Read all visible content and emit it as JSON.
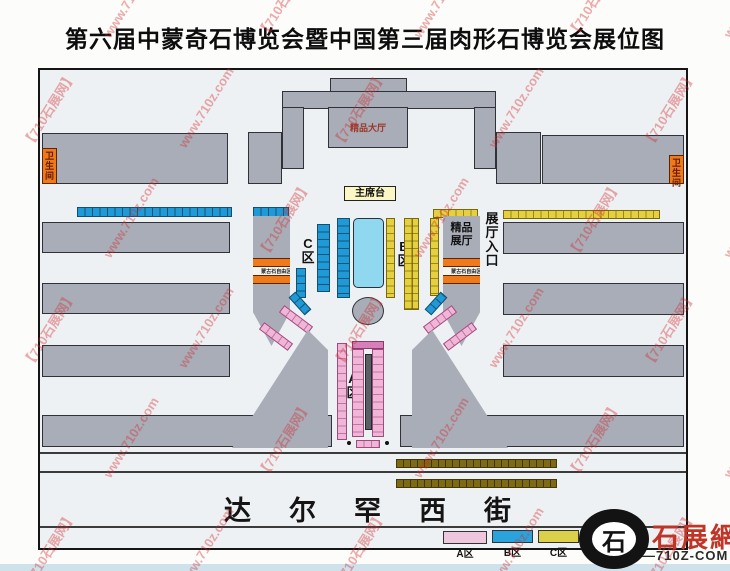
{
  "title": "第六届中蒙奇石博览会暨中国第三届肉形石博览会展位图",
  "watermark": {
    "texts": [
      "【710石展网】",
      "www.710z.com"
    ],
    "color": "#d42a2a",
    "opacity": 0.38,
    "angle_deg": -58
  },
  "map": {
    "buildings": {
      "boutique_hall": "精品大厅",
      "boutique_pavilion": "精品展厅",
      "restroom": "卫生间",
      "stage": "主席台",
      "hall_entrance": "展厅入口",
      "mongolian_stone_area": "蒙古石自由区"
    },
    "zones": {
      "a": "A区",
      "b": "B区",
      "c": "C区"
    },
    "street": "达尔罕西街",
    "colors": {
      "building_gray": "#a8adb8",
      "zone_a_pink": "#f0b6d7",
      "zone_b_blue": "#1f9ad6",
      "zone_c_yellow": "#e4d040",
      "pool_cyan": "#8fd8ef",
      "orange_band": "#ee7a1a",
      "olive_strip": "#7d6a12"
    }
  },
  "legend": {
    "items": [
      {
        "label": "A区",
        "color": "#eec6de"
      },
      {
        "label": "B区",
        "color": "#2aa3dc"
      },
      {
        "label": "C区",
        "color": "#dccf4a"
      }
    ]
  },
  "logo": {
    "brand": "石展網",
    "domain": "—710Z-COM",
    "mark": "石"
  }
}
